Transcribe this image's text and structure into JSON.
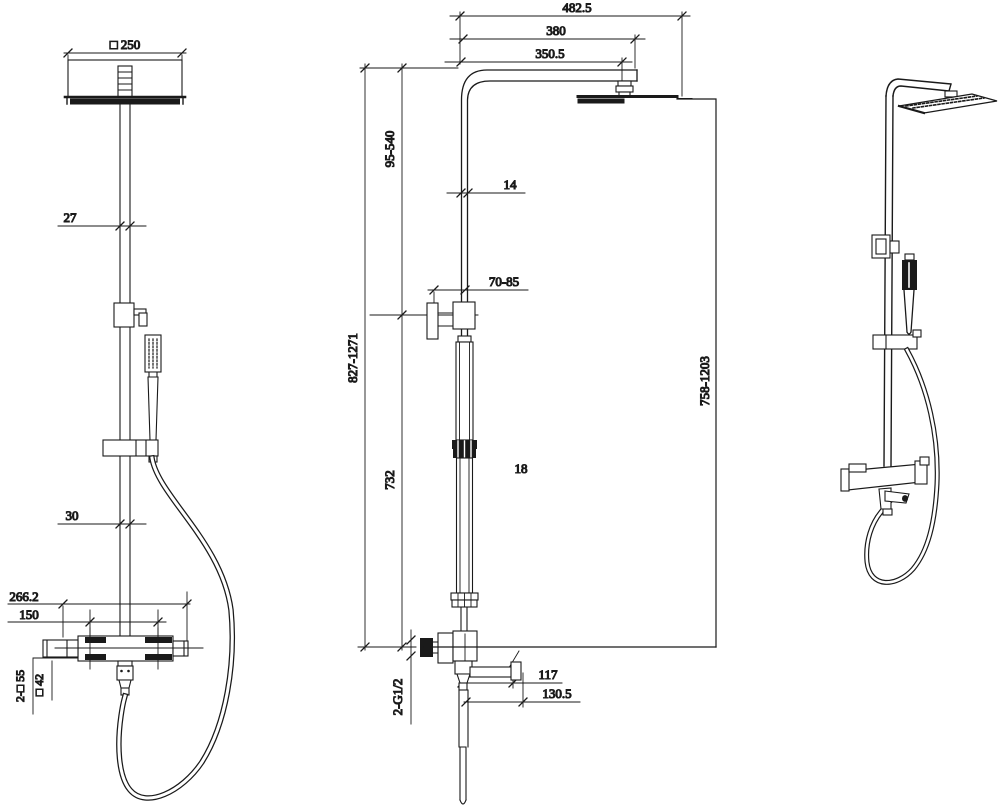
{
  "colors": {
    "line": "#1a1a1a",
    "background": "#ffffff"
  },
  "dimensions": {
    "front": {
      "head_size": "□ 250",
      "upper_pipe": "27",
      "lower_pipe": "30",
      "valve_width": "266.2",
      "handle_centers": "150",
      "wall_squares": "2-□ 55",
      "diverter_square": "□ 42"
    },
    "side": {
      "overall_reach": "482.5",
      "arm_span": "380",
      "arm_reach": "350.5",
      "top_to_bracket": "95-540",
      "riser_dia": "14",
      "bracket_standoff": "70-85",
      "overall_height": "827-1271",
      "lower_riser": "732",
      "tube_dia": "18",
      "head_to_outlet": "758-1203",
      "inlet_threads": "2-G1/2",
      "spout_reach": "117",
      "spout_overall": "130.5"
    }
  }
}
